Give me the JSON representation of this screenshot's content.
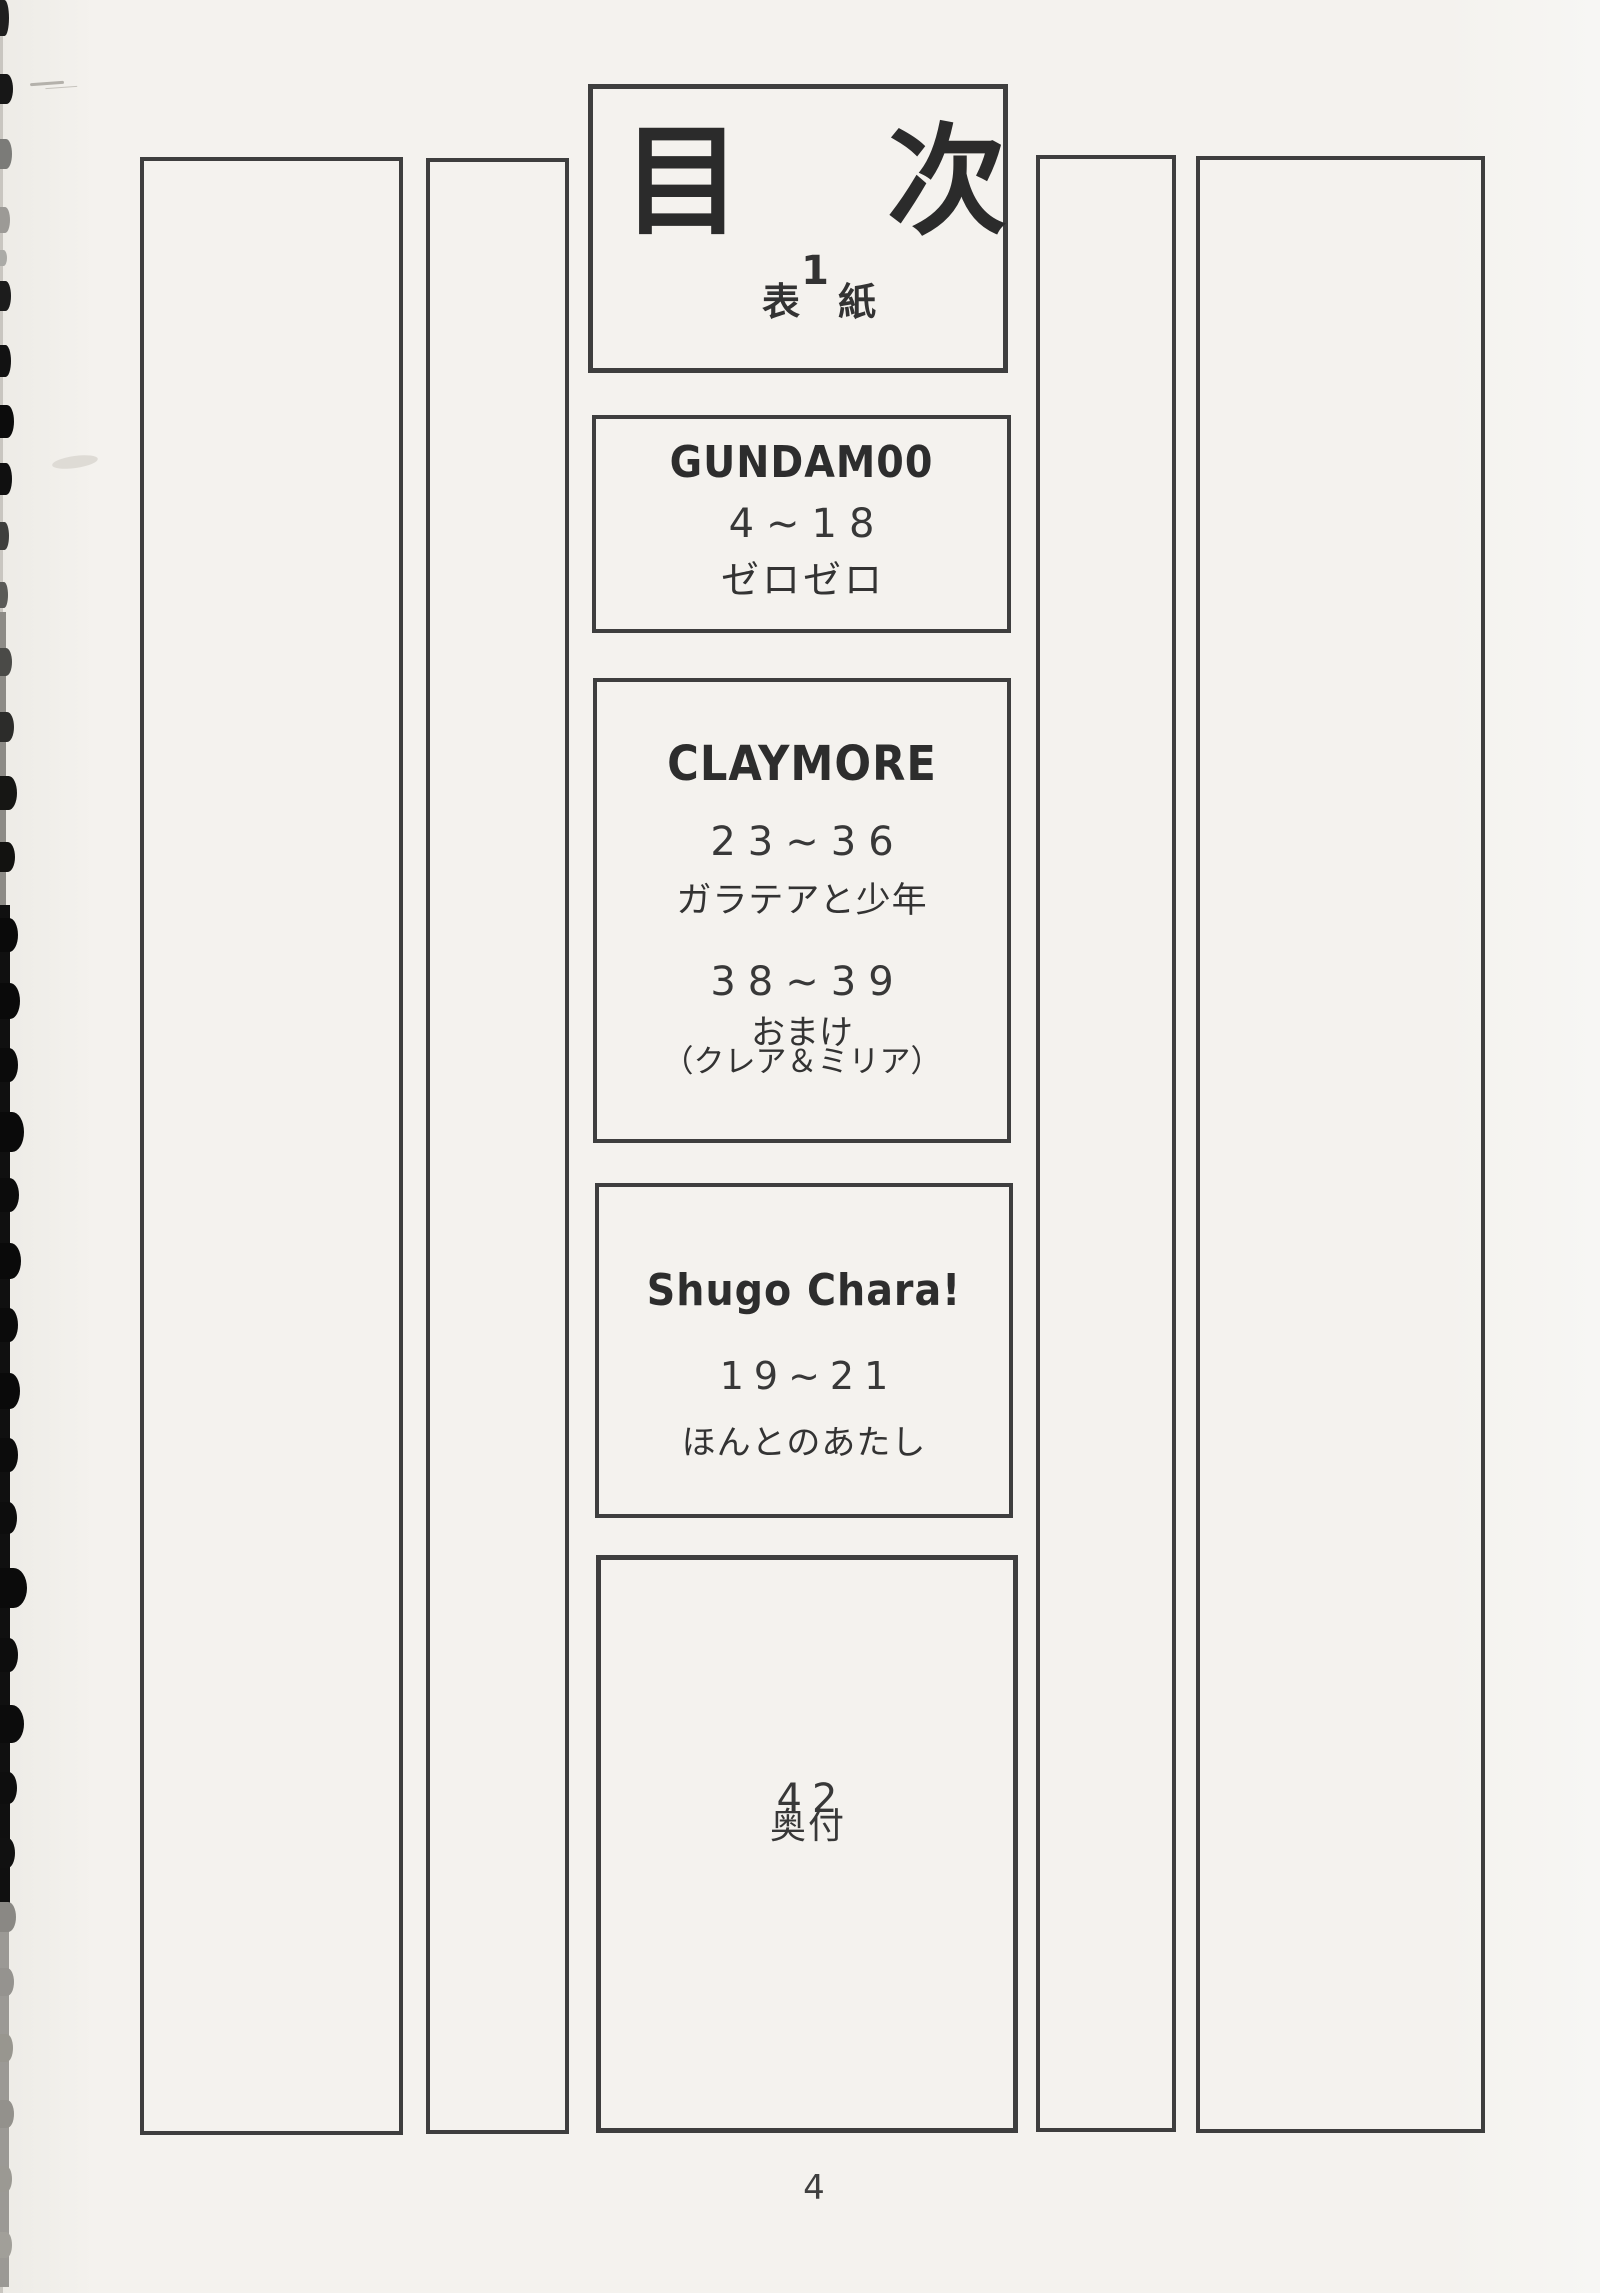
{
  "page": {
    "number": "4"
  },
  "toc": {
    "title": "目次",
    "cover": {
      "page": "1",
      "label": "表紙"
    },
    "entries": [
      {
        "series": "GUNDAM00",
        "pages": "4~18",
        "title": "ゼロゼロ"
      },
      {
        "series": "CLAYMORE",
        "pages": "23~36",
        "title": "ガラテアと少年",
        "pages2": "38~39",
        "bonus": "おまけ",
        "bonus_sub": "（クレア＆ミリア）"
      },
      {
        "series": "Shugo Chara!",
        "pages": "19~21",
        "title": "ほんとのあたし"
      },
      {
        "pages": "42",
        "title": "奥付"
      }
    ]
  },
  "colors": {
    "paper": "#f4f2ee",
    "box_border": "#3e3e3e",
    "ink": "#2e2e2e"
  },
  "scan_edge": {
    "segments": [
      {
        "y": 0,
        "h": 2293,
        "w": 3,
        "c": "#c9c6c0"
      },
      {
        "y": 612,
        "h": 300,
        "w": 6,
        "c": "#8d8b86"
      },
      {
        "y": 905,
        "h": 1000,
        "w": 10,
        "c": "#101010"
      },
      {
        "y": 1905,
        "h": 382,
        "w": 9,
        "c": "#9b9995"
      }
    ],
    "bumps": [
      {
        "y": 0,
        "h": 36,
        "w": 9,
        "c": "#1f1f1f"
      },
      {
        "y": 74,
        "h": 30,
        "w": 13,
        "c": "#171717"
      },
      {
        "y": 139,
        "h": 30,
        "w": 12,
        "c": "#7b7b78"
      },
      {
        "y": 207,
        "h": 26,
        "w": 10,
        "c": "#9c9a96"
      },
      {
        "y": 250,
        "h": 16,
        "w": 7,
        "c": "#ababa7"
      },
      {
        "y": 281,
        "h": 30,
        "w": 11,
        "c": "#1c1c1c"
      },
      {
        "y": 345,
        "h": 32,
        "w": 11,
        "c": "#121212"
      },
      {
        "y": 405,
        "h": 33,
        "w": 14,
        "c": "#0c0c0c"
      },
      {
        "y": 463,
        "h": 32,
        "w": 12,
        "c": "#101010"
      },
      {
        "y": 522,
        "h": 28,
        "w": 9,
        "c": "#3f3f3d"
      },
      {
        "y": 582,
        "h": 26,
        "w": 8,
        "c": "#5a5a57"
      },
      {
        "y": 648,
        "h": 28,
        "w": 12,
        "c": "#4a4a47"
      },
      {
        "y": 712,
        "h": 30,
        "w": 14,
        "c": "#2c2c2a"
      },
      {
        "y": 776,
        "h": 34,
        "w": 17,
        "c": "#161614"
      },
      {
        "y": 842,
        "h": 30,
        "w": 15,
        "c": "#121210"
      },
      {
        "y": 918,
        "h": 34,
        "w": 18,
        "c": "#0a0a0a"
      },
      {
        "y": 983,
        "h": 36,
        "w": 20,
        "c": "#0a0a0a"
      },
      {
        "y": 1048,
        "h": 34,
        "w": 18,
        "c": "#0b0b0b"
      },
      {
        "y": 1112,
        "h": 40,
        "w": 24,
        "c": "#0a0a0a"
      },
      {
        "y": 1178,
        "h": 34,
        "w": 19,
        "c": "#0c0c0c"
      },
      {
        "y": 1243,
        "h": 36,
        "w": 21,
        "c": "#0a0a0a"
      },
      {
        "y": 1308,
        "h": 34,
        "w": 18,
        "c": "#0b0b0b"
      },
      {
        "y": 1373,
        "h": 36,
        "w": 20,
        "c": "#0a0a0a"
      },
      {
        "y": 1438,
        "h": 34,
        "w": 18,
        "c": "#0c0c0c"
      },
      {
        "y": 1502,
        "h": 32,
        "w": 17,
        "c": "#0d0d0d"
      },
      {
        "y": 1568,
        "h": 40,
        "w": 27,
        "c": "#0b0b0b"
      },
      {
        "y": 1638,
        "h": 34,
        "w": 18,
        "c": "#0d0d0d"
      },
      {
        "y": 1705,
        "h": 38,
        "w": 24,
        "c": "#0c0c0c"
      },
      {
        "y": 1772,
        "h": 32,
        "w": 17,
        "c": "#0e0e0e"
      },
      {
        "y": 1838,
        "h": 30,
        "w": 15,
        "c": "#111111"
      },
      {
        "y": 1902,
        "h": 30,
        "w": 16,
        "c": "#8a8884"
      },
      {
        "y": 1968,
        "h": 28,
        "w": 14,
        "c": "#95938f"
      },
      {
        "y": 2034,
        "h": 28,
        "w": 13,
        "c": "#98968f"
      },
      {
        "y": 2100,
        "h": 28,
        "w": 14,
        "c": "#93918c"
      },
      {
        "y": 2166,
        "h": 26,
        "w": 12,
        "c": "#9b9993"
      },
      {
        "y": 2232,
        "h": 26,
        "w": 12,
        "c": "#a19f99"
      }
    ]
  }
}
